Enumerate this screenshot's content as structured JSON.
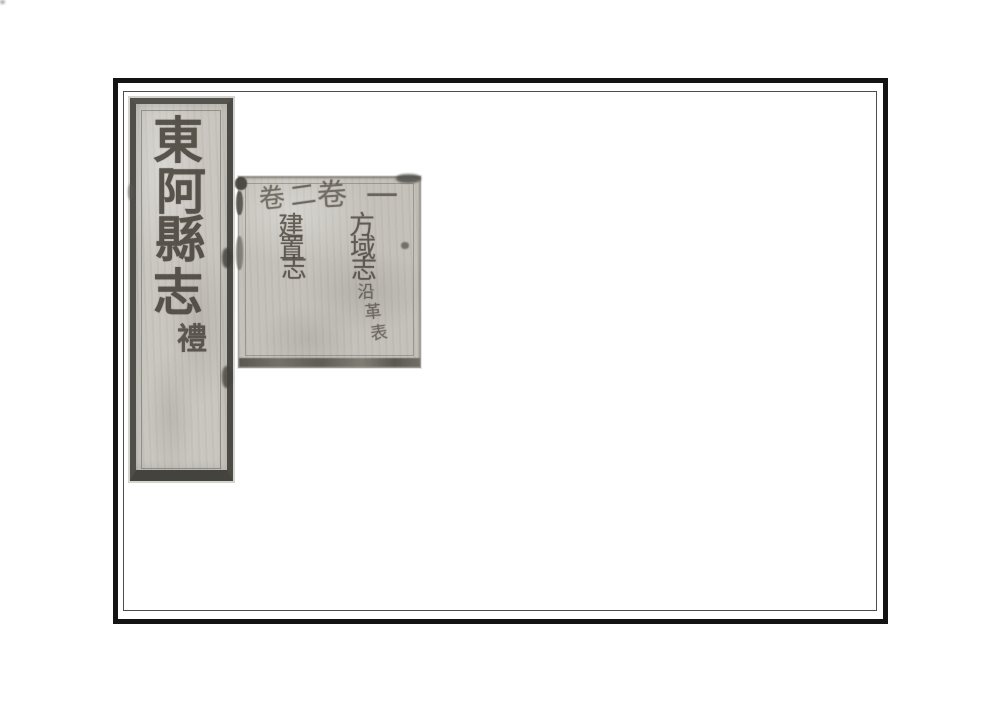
{
  "document_title": "東阿縣志",
  "title_strip": {
    "characters": [
      "東",
      "阿",
      "縣",
      "志"
    ],
    "volume_marker": "禮"
  },
  "toc": {
    "entries": [
      {
        "volume_label": "卷",
        "volume_number": "一",
        "title": "方域志",
        "title_chars": [
          "方",
          "域",
          "志"
        ],
        "annotation": "沿革表",
        "annotation_chars": [
          "沿",
          "革",
          "表"
        ]
      },
      {
        "volume_label": "卷",
        "volume_number": "二",
        "title": "建置志",
        "title_chars": [
          "建",
          "置",
          "志"
        ],
        "annotation": "",
        "annotation_chars": []
      }
    ]
  },
  "colors": {
    "page_background": "#ffffff",
    "paper_strip": "#c9c6c0",
    "paper_block": "#c4c1ba",
    "ink": "#474239",
    "frame": "#141414"
  }
}
